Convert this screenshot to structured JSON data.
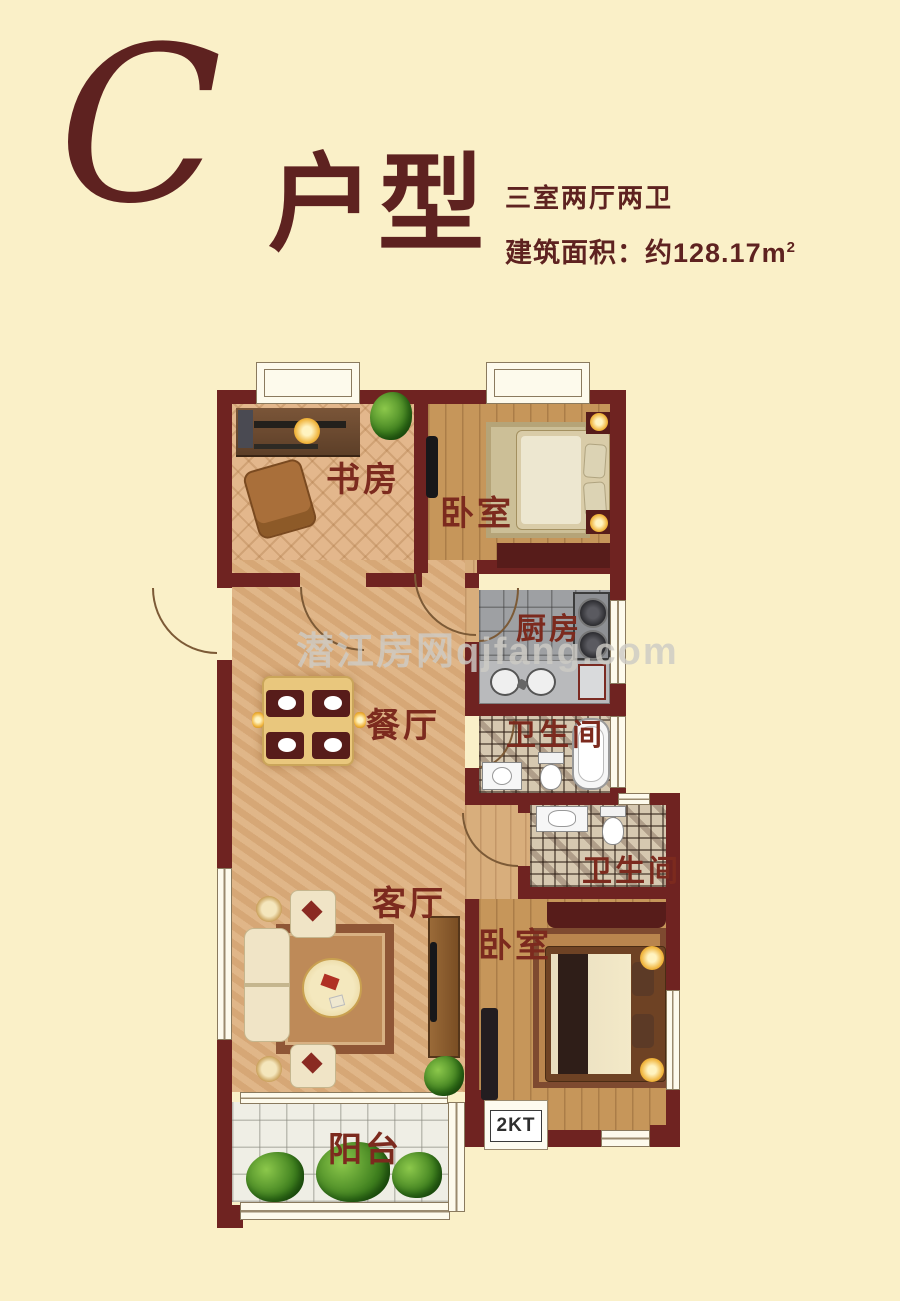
{
  "header": {
    "letter": "C",
    "title": "户型",
    "spec": "三室两厅两卫",
    "area_label": "建筑面积：约",
    "area_value": "128.17m",
    "area_sup": "2"
  },
  "watermark": "潜江房网qjfang.com",
  "rooms": {
    "study": "书房",
    "bedroom_top": "卧室",
    "kitchen": "厨房",
    "bath_top": "卫生间",
    "dining": "餐厅",
    "living": "客厅",
    "bath_bottom": "卫生间",
    "bedroom_bottom": "卧室",
    "balcony": "阳台",
    "ac_platform": "2KT"
  },
  "colors": {
    "background": "#FAF0C8",
    "wall": "#6F2321",
    "label_text": "#7C2A1E",
    "accent_maroon": "#571C1A"
  }
}
